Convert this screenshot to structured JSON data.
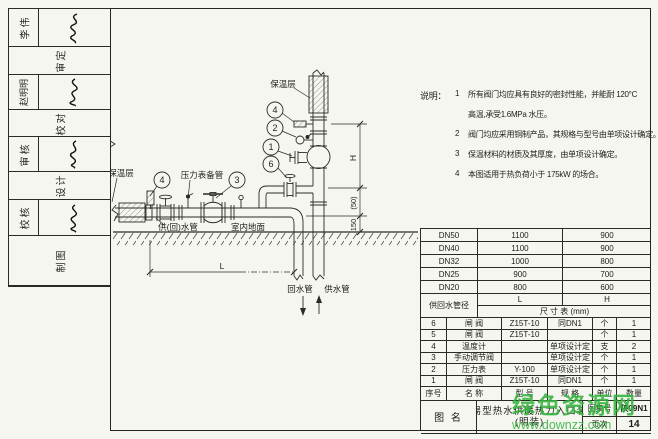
{
  "sheet": {
    "atlas_no": "陕09N1",
    "page_no": "14"
  },
  "sidebar": {
    "cells": [
      {
        "type": "pair",
        "text": "李伟"
      },
      {
        "type": "label",
        "text": "审定"
      },
      {
        "type": "pair",
        "text": "赵明明"
      },
      {
        "type": "label",
        "text": "校对"
      },
      {
        "type": "pair",
        "text": "审核"
      },
      {
        "type": "label",
        "text": "设计"
      },
      {
        "type": "pair",
        "text": "校核"
      },
      {
        "type": "label",
        "text": "制图"
      }
    ]
  },
  "notes": {
    "heading": "说明：",
    "item1_num": "1",
    "item1_line1": "所有阀门均应具有良好的密封性能，并能耐 120°C",
    "item1_line2": "高温,承受1.6MPa 水压。",
    "item2_num": "2",
    "item2_text": "阀门均应采用铜制产品，其规格与型号由单项设计确定。",
    "item3_num": "3",
    "item3_text": "保温材料的材质及其厚度，由单项设计确定。",
    "item4_num": "4",
    "item4_text": "本图适用于热负荷小于 175kW 的场合。"
  },
  "diagram": {
    "labels": {
      "insulation_left": "保温层",
      "insulation_riser": "保温层",
      "gauge_spare_pipe": "压力表备管",
      "supply_return_pipe": "供(回)水管",
      "indoor_floor": "室内地面",
      "return_pipe": "回水管",
      "supply_pipe": "供水管"
    },
    "dims": {
      "h": "H",
      "mid": "(50)",
      "bottom": "150",
      "l": "L"
    },
    "callouts": {
      "c4a": "4",
      "c3": "3",
      "c4b": "4",
      "c2": "2",
      "c1": "1",
      "c6": "6"
    }
  },
  "dim_table": {
    "corner_header": "供回水管径",
    "col_l": "L",
    "col_h": "H",
    "title": "尺 寸 表 (mm)",
    "rows": [
      {
        "dn": "DN50",
        "l": "1100",
        "h": "900"
      },
      {
        "dn": "DN40",
        "l": "1100",
        "h": "900"
      },
      {
        "dn": "DN32",
        "l": "1000",
        "h": "800"
      },
      {
        "dn": "DN25",
        "l": "900",
        "h": "700"
      },
      {
        "dn": "DN20",
        "l": "800",
        "h": "600"
      }
    ]
  },
  "material_table": {
    "headers": {
      "no": "序号",
      "name": "名 称",
      "model": "型 号",
      "spec": "规 格",
      "unit": "单位",
      "qty": "数量"
    },
    "rows": [
      {
        "no": "6",
        "name": "闸 阀",
        "model": "Z15T-10",
        "spec": "同DN1",
        "unit": "个",
        "qty": "1"
      },
      {
        "no": "5",
        "name": "闸 阀",
        "model": "Z15T-10",
        "spec": "",
        "unit": "个",
        "qty": "1"
      },
      {
        "no": "4",
        "name": "温度计",
        "model": "",
        "spec": "单项设计定",
        "unit": "支",
        "qty": "2"
      },
      {
        "no": "3",
        "name": "手动调节阀",
        "model": "",
        "spec": "单项设计定",
        "unit": "个",
        "qty": "1"
      },
      {
        "no": "2",
        "name": "压力表",
        "model": "Y-100",
        "spec": "单项设计定",
        "unit": "个",
        "qty": "1"
      },
      {
        "no": "1",
        "name": "闸 阀",
        "model": "Z15T-10",
        "spec": "同DN1",
        "unit": "个",
        "qty": "1"
      }
    ]
  },
  "title_bar": {
    "label": "图 名",
    "title_line1": "简易型热水供暖热力入口装置",
    "title_line2": "(明装)",
    "atlas_label": "图集号",
    "atlas_no": "陕09N1",
    "page_label": "页次",
    "page_no": "14"
  },
  "watermark": {
    "line1": "绿色资源网",
    "line2": "www.downzz.com",
    "color": "#35b33e"
  }
}
